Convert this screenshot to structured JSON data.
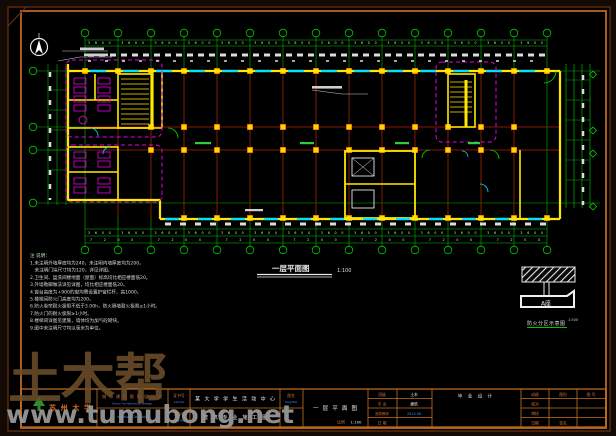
{
  "plan": {
    "title": "一层平面图",
    "scale": "1:100",
    "dims_top": "3600  3600  3600  3600  3600  3600  3600  3600  3600  3600  3600  3600  3600  3600",
    "dims_bottom1": "3600  3600  3600  3600  3600  3600  3600  3600  3600  3600  3600  3600  3600  3600",
    "dims_bottom2": "7200  7200  7200  7200  7200  7200  7200"
  },
  "detail": {
    "label": "A座",
    "caption": "防火分区示意图",
    "scale": "1:500"
  },
  "notes": {
    "header": "注   说明：",
    "items": [
      "1.未注明外墙厚度均为240，未注明内墙厚度均为200。",
      "　未注明门垛尺寸均为120，详见详图。",
      "2.卫生间、盥洗间楼地面（屋面）标高均比相应楼面低20。",
      "3.外墙勒脚做法详见详图，均比相应楼面低20。",
      "4.窗台高度为+900的窗均需设置护窗栏杆，高1000。",
      "5.楼梯间防火门高度均为200。",
      "6.防火卷帘耐火极限不低于3.00h，防火隔墙耐火极限≥1小时。",
      "7.防火门的耐火极限≥1小时。",
      "8.楼梯间详图见建施，墙体均为加气砼砌块。",
      "9.图中未注明尺寸均以毫米为单位。"
    ]
  },
  "titleblock": {
    "university": "苏州大学",
    "institute": {
      "cn": "城市建筑勘察设计院",
      "en1": "Urban Architectural Design",
      "en2": "Institute Co., Ltd."
    },
    "cert": {
      "label1_cn": "证书号",
      "label1_en": "Cert-No",
      "label2_cn": "工程号",
      "label2_en": "Proj-No"
    },
    "project": {
      "line1": "某大学学生活动中心",
      "line2": "建筑专业施工图"
    },
    "dwg": {
      "label_cn": "图名",
      "label_en": "DwgTitle",
      "name": "一层平面图",
      "scale_label": "比例",
      "scale": "1:100"
    },
    "student": {
      "rows": [
        {
          "label": "班级",
          "value": "土木"
        },
        {
          "label": "专 业",
          "value": "建筑"
        },
        {
          "label": "指导教师",
          "value": "2014.06"
        },
        {
          "label": "日 期",
          "value": ""
        }
      ],
      "type": "毕 业 设 计"
    },
    "right": {
      "r1c1": "成绩",
      "r1c2": "图别",
      "r1c3": "图 号",
      "r2c1": "校对",
      "r3c1": "审核",
      "r4c1": "日期",
      "r4c2": "签名"
    }
  },
  "watermark": {
    "brand": "土木帮",
    "site": "www.tumubong.net"
  },
  "colors": {
    "frame": "#a85c20",
    "axis_green": "#00c800",
    "grid_red": "#b40000",
    "wall_yellow": "#ffe800",
    "window_cyan": "#00e0ff",
    "fixture_magenta": "#e800e8",
    "label_orange": "#cc6f1e",
    "label_blue": "#3d8bff"
  }
}
